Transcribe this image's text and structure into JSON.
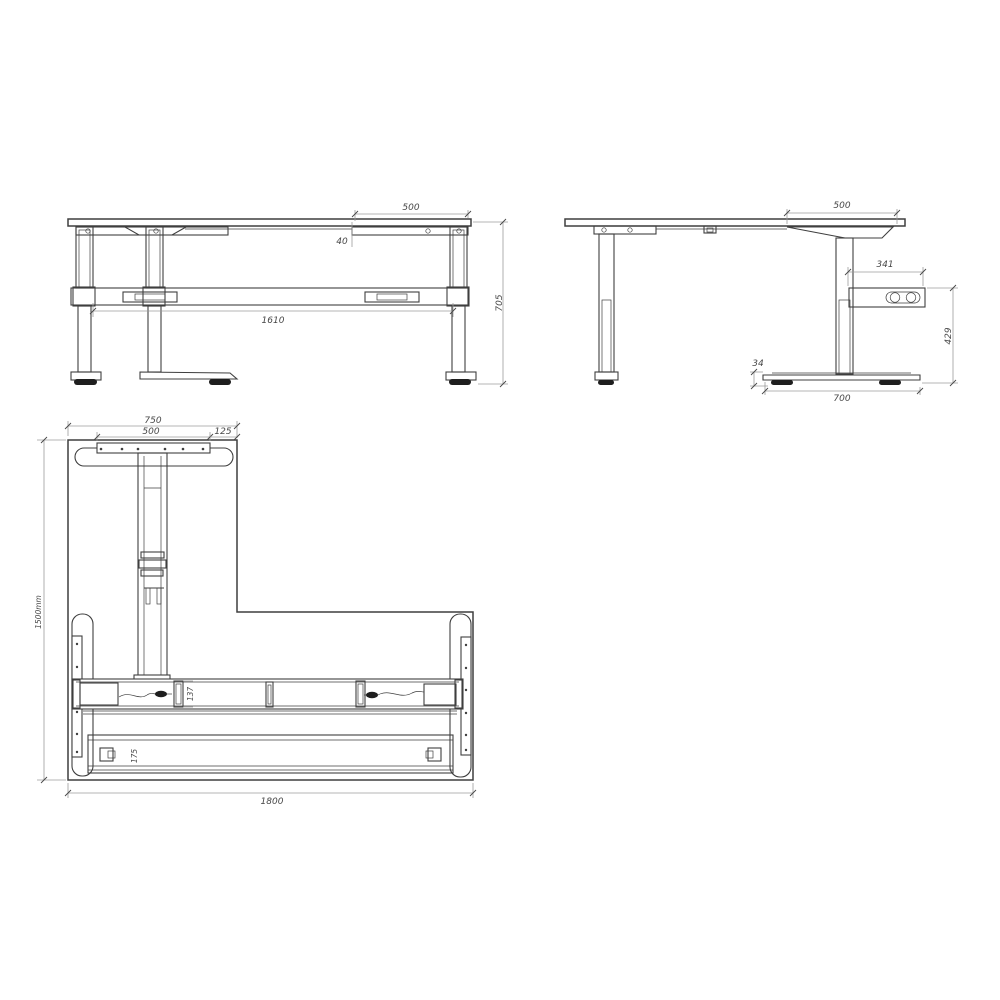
{
  "drawing": {
    "colors": {
      "background": "#ffffff",
      "line": "#3f3f3f",
      "dim_line": "#9b9b9b",
      "text": "#474747",
      "dark_fill": "#1e1e1e"
    },
    "views": {
      "front": {
        "dims": {
          "top_bracket_width": "500",
          "bracket_offset": "40",
          "leg_span": "1610",
          "overall_height": "705"
        }
      },
      "side": {
        "dims": {
          "top_bracket_width": "500",
          "control_box_width": "341",
          "control_box_height_above_floor": "429",
          "foot_height": "34",
          "foot_depth": "700"
        }
      },
      "plan": {
        "dims": {
          "return_section_width": "750",
          "foot_plate_width": "500",
          "corner_offset": "125",
          "overall_depth": "1500mm",
          "beam_depth": "137",
          "rail_depth": "175",
          "overall_width": "1800"
        }
      }
    }
  }
}
